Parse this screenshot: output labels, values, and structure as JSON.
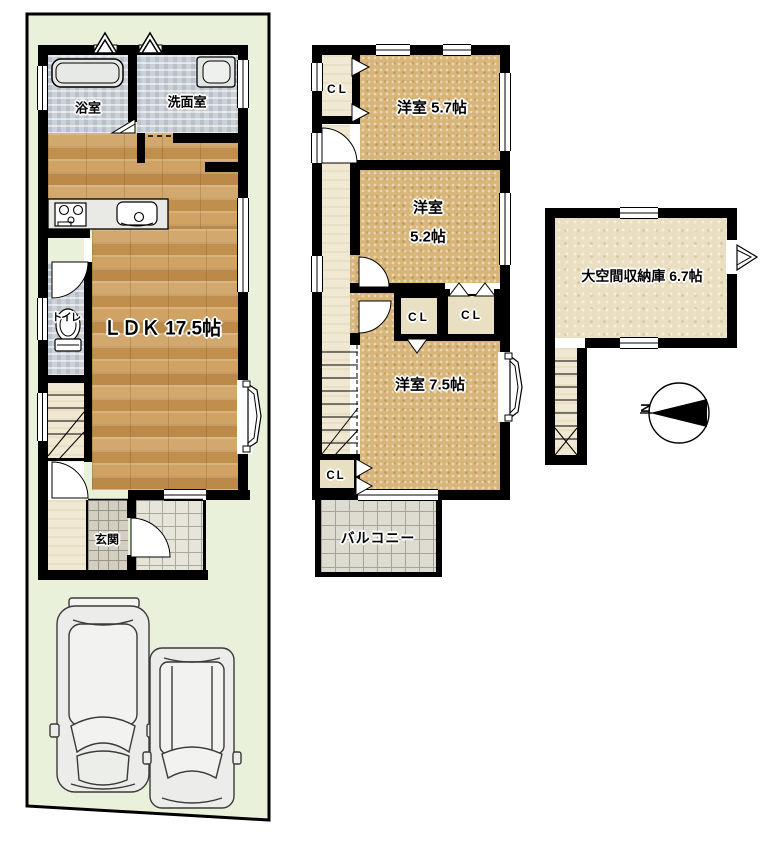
{
  "plan": {
    "floor1": {
      "bath_label": "浴室",
      "washroom_label": "洗面室",
      "toilet_label": "トイレ",
      "ldk_label": "ＬＤＫ 17.5帖",
      "entrance_label": "玄関",
      "parking_car_count": 2
    },
    "floor2": {
      "closet_top_label": "CL",
      "room_57_label": "洋室 5.7帖",
      "room_52_label_line1": "洋室",
      "room_52_label_line2": "5.2帖",
      "closet_left_label": "CL",
      "closet_right_label": "CL",
      "room_75_label": "洋室 7.5帖",
      "closet_bottom_label": "CL",
      "balcony_label": "バルコニー"
    },
    "storage_floor": {
      "storage_label": "大空間収納庫 6.7帖"
    },
    "compass": {
      "north_label": "N"
    },
    "colors": {
      "lot_green": "#eaf1da",
      "wall_black": "#000000",
      "wood_floor": "#c9995c",
      "sand_floor": "#d8b67a",
      "wet_floor": "#cbd1d7",
      "cream_floor": "#f0e8d3",
      "storage_floor": "#eadfc2",
      "tile_grey": "#d3d0c1"
    }
  }
}
